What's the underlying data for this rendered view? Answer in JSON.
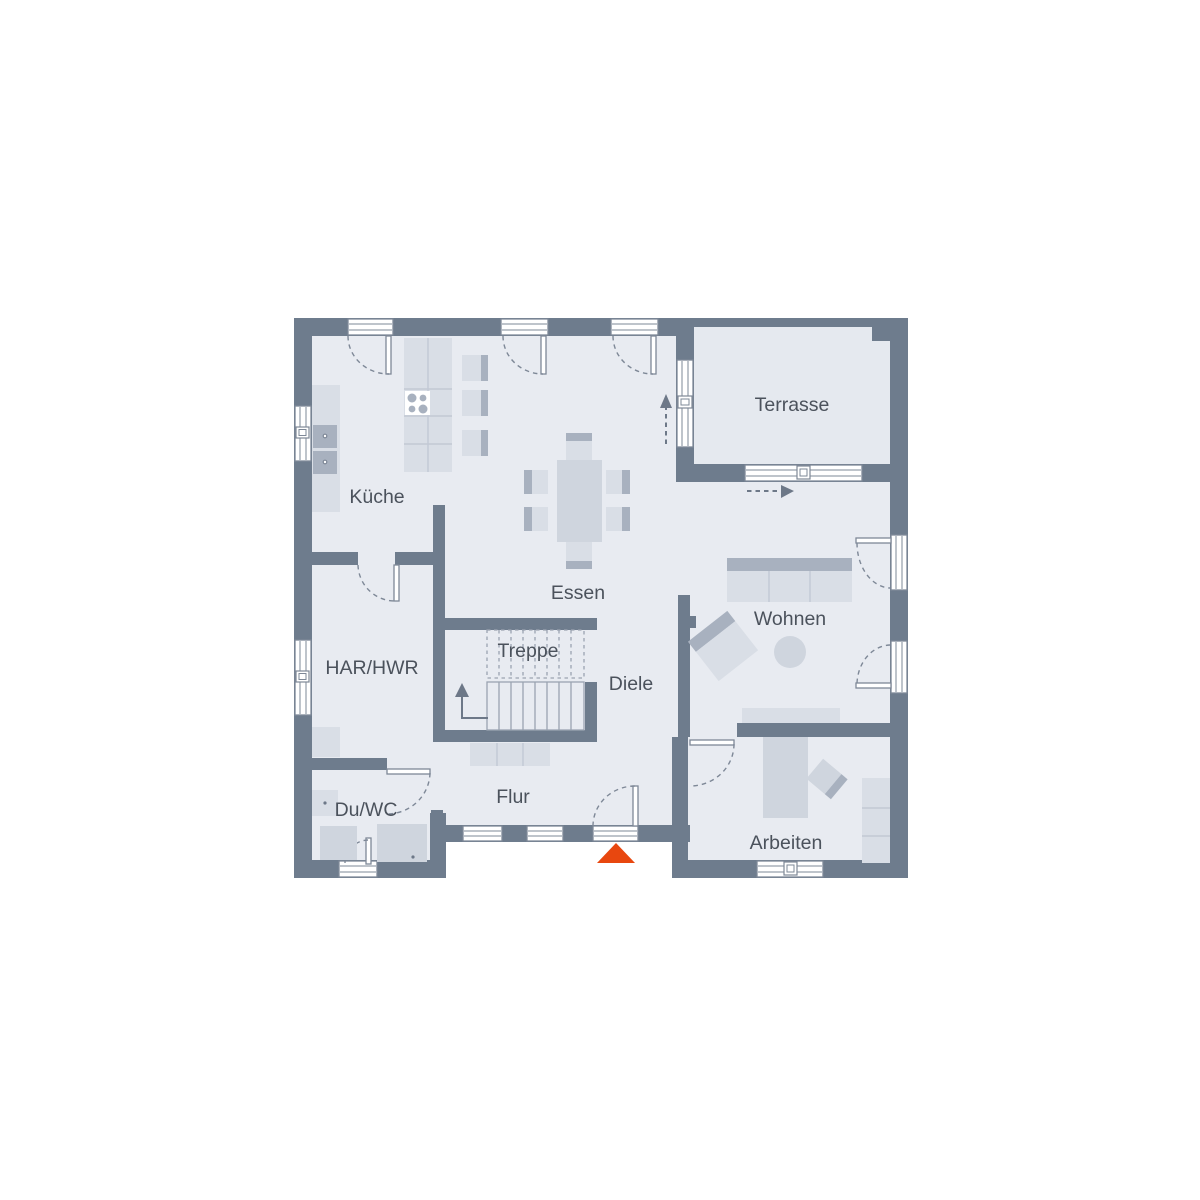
{
  "title": "Grundriss Erdgeschoss",
  "colors": {
    "wall": "#6e7c8d",
    "floor": "#e8ebf1",
    "terrace_floor": "#e5e9ef",
    "furniture_light": "#d9dee6",
    "furniture_medium": "#cfd5de",
    "furniture_dark": "#a8b1bf",
    "grid_line": "#c2c9d4",
    "stair_line": "#9aa3b1",
    "line": "#7e8897",
    "arrow": "#6d7888",
    "label_text": "#4b525c",
    "accent": "#e8470f"
  },
  "rooms": {
    "kueche": {
      "label": "Küche"
    },
    "essen": {
      "label": "Essen"
    },
    "terrasse": {
      "label": "Terrasse"
    },
    "wohnen": {
      "label": "Wohnen"
    },
    "har_hwr": {
      "label": "HAR/HWR"
    },
    "treppe": {
      "label": "Treppe"
    },
    "diele": {
      "label": "Diele"
    },
    "du_wc": {
      "label": "Du/WC"
    },
    "flur": {
      "label": "Flur"
    },
    "arbeiten": {
      "label": "Arbeiten"
    }
  },
  "markers": {
    "entrance": {
      "icon": "triangle-up",
      "meaning": "entrance"
    },
    "terrace_exit_up": {
      "icon": "dashed-arrow-up"
    },
    "terrace_exit_right": {
      "icon": "dashed-arrow-right"
    },
    "stairs_up": {
      "icon": "arrow-up"
    }
  }
}
